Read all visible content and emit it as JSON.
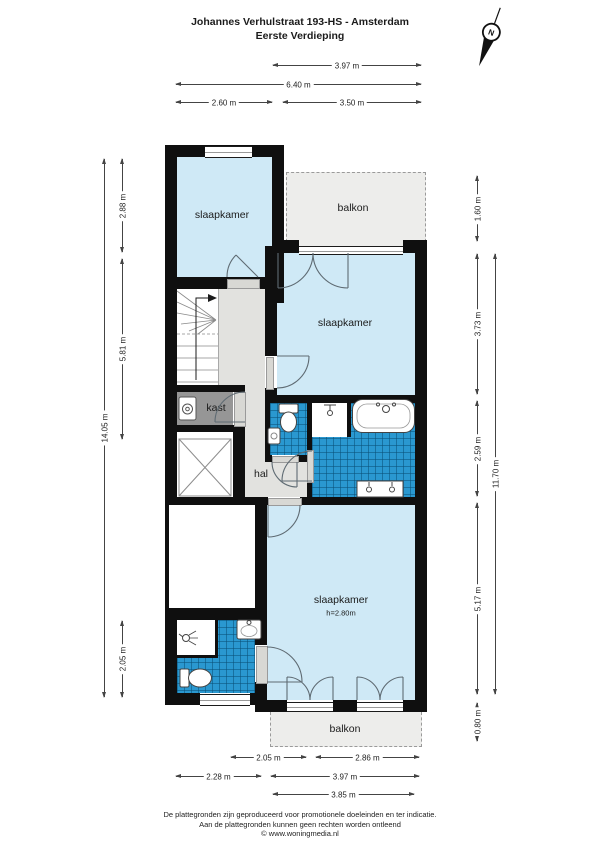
{
  "title": {
    "line1": "Johannes Verhulstraat 193-HS - Amsterdam",
    "line2": "Eerste Verdieping"
  },
  "compass": {
    "label": "N"
  },
  "floorplan": {
    "rooms": {
      "bedroom_top_left": "slaapkamer",
      "balcony_top": "balkon",
      "bedroom_middle": "slaapkamer",
      "closet": "kast",
      "hall": "hal",
      "bedroom_bottom": "slaapkamer",
      "bedroom_bottom_ceiling": "h=2.80m",
      "balcony_bottom": "balkon"
    },
    "colors": {
      "room_fill": "#cfe9f6",
      "tile_fill": "#2a98d0",
      "hall_fill": "#e2e2df",
      "closet_fill": "#969696",
      "balcony_fill": "#ededeb",
      "wall": "#0f0f0f"
    }
  },
  "dimensions": {
    "top": [
      "3.97 m",
      "6.40 m",
      "2.60 m",
      "3.50 m"
    ],
    "left": [
      "2.88 m",
      "5.81 m",
      "2.05 m",
      "14.05 m"
    ],
    "right": [
      "1.60 m",
      "3.73 m",
      "2.59 m",
      "5.17 m",
      "0.80 m",
      "11.70 m"
    ],
    "bottom": [
      "2.05 m",
      "2.86 m",
      "2.28 m",
      "3.97 m",
      "3.85 m"
    ]
  },
  "footer": {
    "line1": "De plattegronden zijn geproduceerd voor promotionele doeleinden en ter indicatie.",
    "line2": "Aan de plattegronden kunnen geen rechten worden ontleend",
    "line3": "© www.woningmedia.nl"
  }
}
